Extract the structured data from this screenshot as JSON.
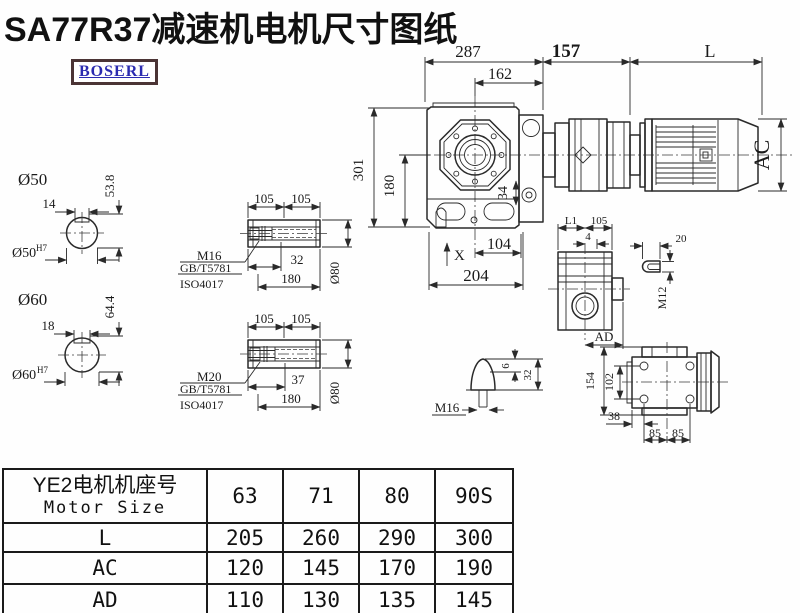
{
  "title": "SA77R37减速机电机尺寸图纸",
  "logo": {
    "text": "BOSERL"
  },
  "colors": {
    "line": "#2a2a2a",
    "logo_text": "#2b2bb0",
    "logo_border": "#4b3435",
    "background": "#fefefe"
  },
  "main_view": {
    "top_dims": {
      "d287": "287",
      "d162": "162",
      "d157": "157",
      "dL": "L"
    },
    "left_dims": {
      "d301": "301",
      "d180": "180"
    },
    "bottom_dims": {
      "dX": "X",
      "d104": "104",
      "d204": "204"
    },
    "flange_dim": "34",
    "motor_dim_ac": "AC"
  },
  "shaft_50": {
    "label": "Ø50",
    "key_width": "14",
    "height": "53.8",
    "bore": "Ø50",
    "fit": "H7"
  },
  "shaft_60": {
    "label": "Ø60",
    "key_width": "18",
    "height": "64.4",
    "bore": "Ø60",
    "fit": "H7"
  },
  "hollow_m16": {
    "d105a": "105",
    "d105b": "105",
    "thread": "M16",
    "std1": "GB/T5781",
    "std2": "ISO4017",
    "d32": "32",
    "d180": "180",
    "dia": "Ø80"
  },
  "hollow_m20": {
    "d105a": "105",
    "d105b": "105",
    "thread": "M20",
    "std1": "GB/T5781",
    "std2": "ISO4017",
    "d37": "37",
    "d180": "180",
    "dia": "Ø80"
  },
  "side_view": {
    "dL1": "L1",
    "d105": "105",
    "d4": "4",
    "dAD": "AD"
  },
  "key_detail": {
    "d20": "20",
    "thread": "M12"
  },
  "plug_detail": {
    "thread": "M16",
    "d6": "6",
    "d32": "32"
  },
  "rear_view": {
    "d154": "154",
    "d102": "102",
    "d38": "38",
    "d85a": "85",
    "d85b": "85"
  },
  "table": {
    "header_line1": "YE2电机机座号",
    "header_line2": "Motor Size",
    "columns": [
      "63",
      "71",
      "80",
      "90S"
    ],
    "rows": [
      {
        "label": "L",
        "values": [
          "205",
          "260",
          "290",
          "300"
        ]
      },
      {
        "label": "AC",
        "values": [
          "120",
          "145",
          "170",
          "190"
        ]
      },
      {
        "label": "AD",
        "values": [
          "110",
          "130",
          "135",
          "145"
        ]
      }
    ]
  }
}
